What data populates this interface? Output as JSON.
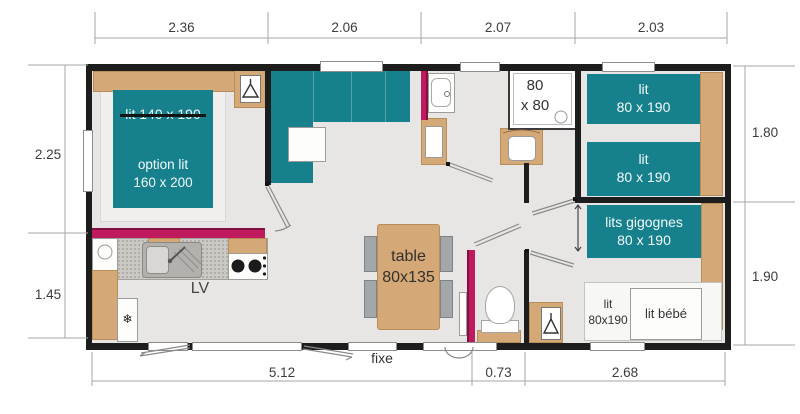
{
  "dims": {
    "top": [
      "2.36",
      "2.06",
      "2.07",
      "2.03"
    ],
    "left": [
      "2.25",
      "1.45"
    ],
    "right": [
      "1.80",
      "1.90"
    ],
    "bottom": [
      "5.12",
      "0.73",
      "2.68"
    ]
  },
  "master_bedroom": {
    "bed_label": "lit 140 x 190",
    "option_line1": "option lit",
    "option_line2": "160 x 200"
  },
  "kitchen": {
    "dishwasher_label": "LV",
    "fridge_glyph": "❄"
  },
  "dining": {
    "table_line1": "table",
    "table_line2": "80x135"
  },
  "bathroom": {
    "shower_line1": "80",
    "shower_line2": "x 80"
  },
  "twin_bedroom": {
    "bed1_line1": "lit",
    "bed1_line2": "80 x 190",
    "bed2_line1": "lit",
    "bed2_line2": "80 x 190"
  },
  "bunk_bedroom": {
    "bunk_line1": "lits gigognes",
    "bunk_line2": "80 x 190",
    "pullout_line1": "lit",
    "pullout_line2": "80x190",
    "baby_bed_label": "lit bébé"
  },
  "window_note": "fixe",
  "icons": {
    "wardrobe": "hanger-icon",
    "fridge": "snowflake-icon"
  },
  "colors": {
    "bed_teal": "#16808d",
    "accent_magenta": "#c01a5e",
    "wood": "#d5a877",
    "wall": "#1d1d1d",
    "floor": "#e7e6e4"
  }
}
